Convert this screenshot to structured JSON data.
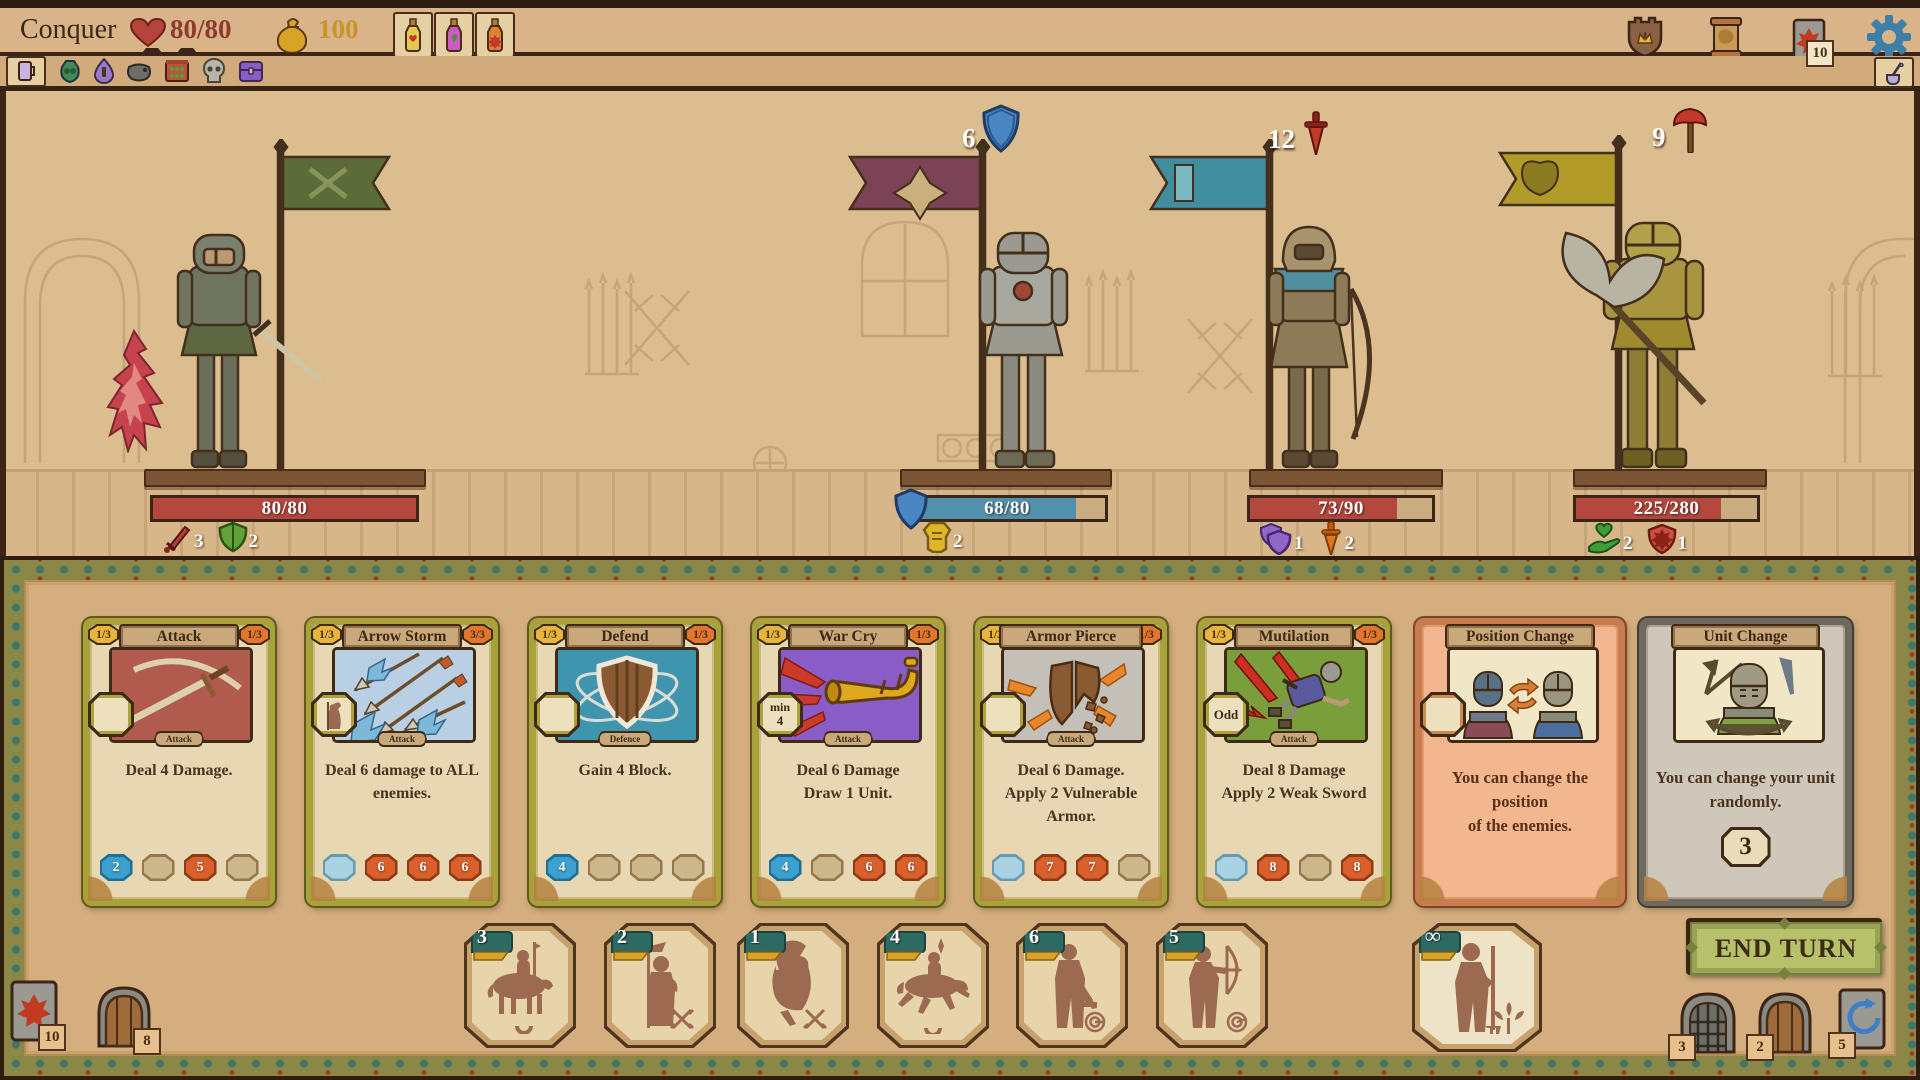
{
  "header": {
    "title": "Conquer",
    "hp": "80/80",
    "gold": "100",
    "potion_icons": [
      "health-potion-icon",
      "magic-potion-icon",
      "damage-potion-icon"
    ],
    "right_icons": [
      "crown-shield-icon",
      "scroll-icon",
      "deck-icon",
      "settings-gear-icon"
    ],
    "deck_badge": "10"
  },
  "toolbar": {
    "item_icons": [
      "tankard-icon",
      "herb-bag-icon",
      "elixir-drop-icon",
      "cauldron-icon",
      "potion-shelf-icon",
      "skull-icon",
      "chest-icon"
    ],
    "right_icon": "ladle-icon"
  },
  "units": [
    {
      "name": "swordsman",
      "hp": "80/80",
      "hp_pct": 100,
      "statuses": [
        {
          "icon": "sword-icon",
          "value": "3"
        },
        {
          "icon": "green-shield-icon",
          "value": "2"
        }
      ]
    },
    {
      "name": "plate-knight",
      "hp": "68/80",
      "hp_pct": 85,
      "intent": {
        "icon": "block-shield-icon",
        "value": "6"
      },
      "statuses": [
        {
          "icon": "armor-icon",
          "value": "2"
        }
      ]
    },
    {
      "name": "hooded-archer",
      "hp": "73/90",
      "hp_pct": 81,
      "intent": {
        "icon": "dagger-icon",
        "value": "12"
      },
      "statuses": [
        {
          "icon": "purple-shield-icon",
          "value": "1"
        },
        {
          "icon": "orange-dagger-icon",
          "value": "2"
        }
      ]
    },
    {
      "name": "heavy-axe-knight",
      "hp": "225/280",
      "hp_pct": 80,
      "intent": {
        "icon": "axe-icon",
        "value": "9"
      },
      "statuses": [
        {
          "icon": "regen-hand-icon",
          "value": "2"
        },
        {
          "icon": "red-shield-icon",
          "value": "1"
        }
      ]
    }
  ],
  "cards": [
    {
      "title": "Attack",
      "left_badge": "1/3",
      "right_badge": "1/3",
      "type_label": "Attack",
      "text": [
        "Deal 4 Damage.",
        ""
      ],
      "costs": [
        "2",
        "",
        "5",
        ""
      ]
    },
    {
      "title": "Arrow Storm",
      "left_badge": "1/3",
      "right_badge": "3/3",
      "type_label": "Attack",
      "text": [
        "Deal 6 damage to ALL",
        "enemies."
      ],
      "costs": [
        "",
        "6",
        "6",
        "6"
      ]
    },
    {
      "title": "Defend",
      "left_badge": "1/3",
      "right_badge": "1/3",
      "type_label": "Defence",
      "text": [
        "Gain 4 Block.",
        ""
      ],
      "costs": [
        "4",
        "",
        "",
        ""
      ]
    },
    {
      "title": "War Cry",
      "left_badge": "1/3",
      "right_badge": "1/3",
      "type_label": "Attack",
      "slot_top": "min",
      "slot_bottom": "4",
      "text": [
        "Deal 6 Damage",
        "Draw 1 Unit."
      ],
      "costs": [
        "4",
        "",
        "6",
        "6"
      ]
    },
    {
      "title": "Armor Pierce",
      "left_badge": "1/3",
      "right_badge": "1/3",
      "type_label": "Attack",
      "text": [
        "Deal 6 Damage.",
        "Apply 2 Vulnerable Armor."
      ],
      "costs": [
        "",
        "7",
        "7",
        ""
      ]
    },
    {
      "title": "Mutilation",
      "left_badge": "1/3",
      "right_badge": "1/3",
      "type_label": "Attack",
      "slot": "Odd",
      "text": [
        "Deal 8 Damage",
        "Apply 2 Weak Sword"
      ],
      "costs": [
        "",
        "8",
        "",
        "8"
      ]
    },
    {
      "title": "Position Change",
      "text": [
        "You can change the position",
        "of the enemies."
      ]
    },
    {
      "title": "Unit Change",
      "text": [
        "You can change your unit",
        "randomly."
      ],
      "center_value": "3"
    }
  ],
  "reserve": {
    "tokens": [
      {
        "count": "3",
        "name": "lancer-cavalry"
      },
      {
        "count": "2",
        "name": "spearman"
      },
      {
        "count": "1",
        "name": "shield-knight"
      },
      {
        "count": "4",
        "name": "sword-cavalry"
      },
      {
        "count": "6",
        "name": "crossbowman"
      },
      {
        "count": "5",
        "name": "archer"
      }
    ],
    "infinite": {
      "count": "∞",
      "name": "peasant"
    }
  },
  "actions": {
    "end_turn": "END TURN"
  },
  "corner_left": [
    {
      "name": "draw-deck",
      "badge": "10"
    },
    {
      "name": "door",
      "badge": "8"
    }
  ],
  "corner_right": [
    {
      "name": "gate",
      "badge": "3"
    },
    {
      "name": "door",
      "badge": "2"
    },
    {
      "name": "redraw",
      "badge": "5"
    }
  ],
  "colors": {
    "accent_red": "#b4473e",
    "accent_blue": "#5291ad",
    "card_olive": "#a9a23a",
    "panel_tan": "#d4ae7e",
    "end_turn_green": "#b7c06a"
  }
}
